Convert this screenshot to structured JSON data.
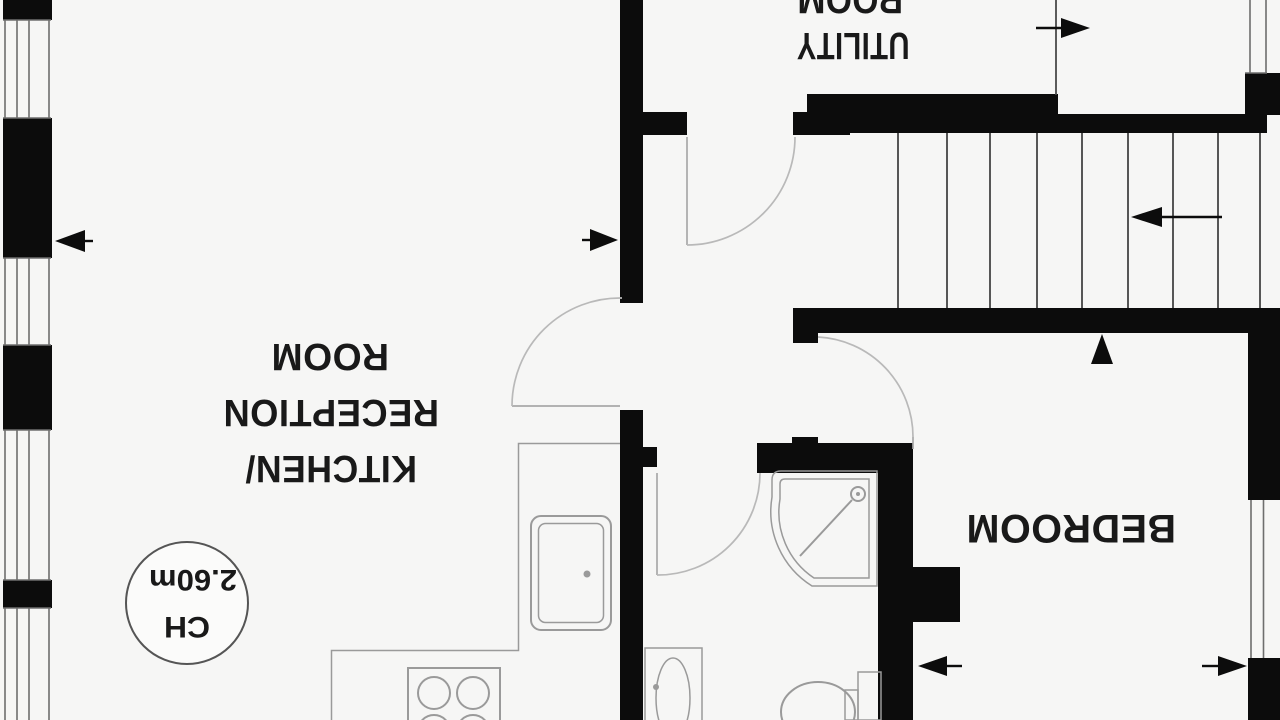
{
  "plan": {
    "type": "floor-plan",
    "orientation_degrees_of_text": 180,
    "labels": {
      "kitchen_line1": "KITCHEN/",
      "kitchen_line2": "RECEPTION",
      "kitchen_line3": "ROOM",
      "utility_line1": "UTILITY",
      "utility_line2": "ROOM",
      "bedroom": "BEDROOM",
      "ceiling_height_line1": "CH",
      "ceiling_height_line2": "2.60m"
    }
  },
  "colors": {
    "wall": "#0c0c0c",
    "fixture_line": "#9a9a9a",
    "door_arc": "#b9b9b9",
    "window_line": "#6e6e6e",
    "stair_line": "#3a3a3a",
    "text": "#191919",
    "background": "#f6f6f5"
  }
}
